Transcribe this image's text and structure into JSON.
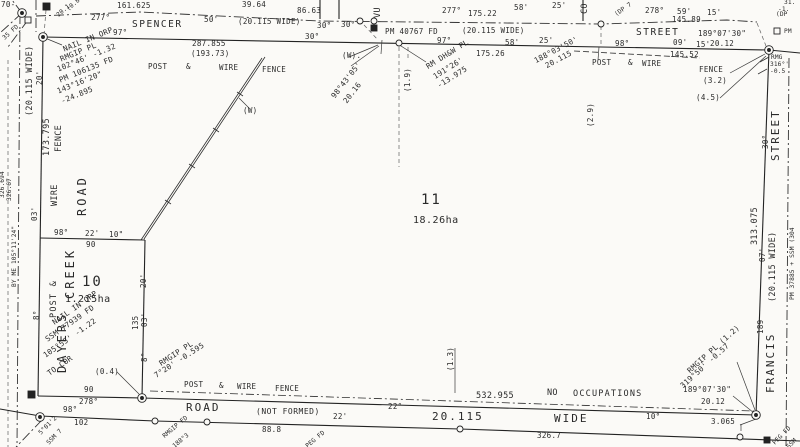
{
  "colors": {
    "paper": "#fbfaf7",
    "ink": "#2a2a2a"
  },
  "plan_summary": {
    "type": "cadastral survey plan (scanned)",
    "lots": [
      {
        "number": "10",
        "area": "1.215ha"
      },
      {
        "number": "11",
        "area": "18.26ha"
      }
    ],
    "streets": [
      "SPENCER STREET",
      "DAYERS CREEK ROAD",
      "FRANCIS STREET",
      "ROAD (NOT FORMED) 20.115 WIDE"
    ]
  },
  "labels": [
    {
      "n": "frag-70",
      "t": "70-",
      "x": 1,
      "y": 1
    },
    {
      "n": "frag-35fd",
      "t": "35 FD",
      "x": 2,
      "y": 37,
      "r": -42,
      "c": "t6"
    },
    {
      "n": "frag-20-1",
      "t": "20.1",
      "x": 56,
      "y": 14,
      "r": -42,
      "c": "t6"
    },
    {
      "n": "frag-0-8",
      "t": "(0.8",
      "x": 66,
      "y": 8,
      "r": -42,
      "c": "t6"
    },
    {
      "n": "dim-161-625",
      "t": "161.625",
      "x": 117,
      "y": 2
    },
    {
      "n": "dim-39-64",
      "t": "39.64",
      "x": 242,
      "y": 1
    },
    {
      "n": "brg-277-a",
      "t": "277°",
      "x": 91,
      "y": 14
    },
    {
      "n": "street-spencer",
      "t": "SPENCER",
      "x": 132,
      "y": 20,
      "c": "st"
    },
    {
      "n": "brg-97-a",
      "t": "97°",
      "x": 113,
      "y": 29
    },
    {
      "n": "dim-50",
      "t": "50'",
      "x": 204,
      "y": 16
    },
    {
      "n": "note-width-1",
      "t": "(20.115 WIDE)",
      "x": 238,
      "y": 18
    },
    {
      "n": "dim-86-63",
      "t": "86.63",
      "x": 297,
      "y": 7
    },
    {
      "n": "brg-30-a",
      "t": "30°",
      "x": 317,
      "y": 22
    },
    {
      "n": "brg-30-b",
      "t": "30°",
      "x": 341,
      "y": 21
    },
    {
      "n": "brg-30-c",
      "t": "30°",
      "x": 305,
      "y": 33
    },
    {
      "n": "street-vu-frag",
      "t": "VU",
      "x": 374,
      "y": 18,
      "r": -90,
      "c": "t8"
    },
    {
      "n": "mark-pm40767",
      "t": "PM 40767 FD",
      "x": 385,
      "y": 28
    },
    {
      "n": "brg-277-b",
      "t": "277°",
      "x": 442,
      "y": 7
    },
    {
      "n": "dim-58-a",
      "t": "58'",
      "x": 514,
      "y": 4
    },
    {
      "n": "dim-25-a",
      "t": "25'",
      "x": 552,
      "y": 2
    },
    {
      "n": "dim-175-22",
      "t": "175.22",
      "x": 468,
      "y": 10
    },
    {
      "n": "note-width-2",
      "t": "(20.115 WIDE)",
      "x": 462,
      "y": 27
    },
    {
      "n": "brg-97-b",
      "t": "97°",
      "x": 437,
      "y": 37
    },
    {
      "n": "dim-58-b",
      "t": "58'",
      "x": 505,
      "y": 39
    },
    {
      "n": "dim-175-26",
      "t": "175.26",
      "x": 476,
      "y": 50
    },
    {
      "n": "dim-287-855",
      "t": "287.855",
      "x": 192,
      "y": 40
    },
    {
      "n": "dim-193-73",
      "t": "(193.73)",
      "x": 191,
      "y": 50
    },
    {
      "n": "fence-post-1",
      "t": "POST",
      "x": 148,
      "y": 63
    },
    {
      "n": "fence-amp-1",
      "t": "&",
      "x": 186,
      "y": 63
    },
    {
      "n": "fence-wire-1",
      "t": "WIRE",
      "x": 219,
      "y": 64
    },
    {
      "n": "fence-fence-1",
      "t": "FENCE",
      "x": 262,
      "y": 66
    },
    {
      "n": "street-co-frag",
      "t": "CO",
      "x": 581,
      "y": 14,
      "r": -90,
      "c": "t8"
    },
    {
      "n": "frag-dp7",
      "t": "(DP 7",
      "x": 614,
      "y": 13,
      "r": -35,
      "c": "t6"
    },
    {
      "n": "brg-278",
      "t": "278°",
      "x": 645,
      "y": 7
    },
    {
      "n": "dim-59",
      "t": "59'",
      "x": 677,
      "y": 8
    },
    {
      "n": "dim-15-a",
      "t": "15'",
      "x": 707,
      "y": 9
    },
    {
      "n": "dim-145-89",
      "t": "145.89",
      "x": 672,
      "y": 16
    },
    {
      "n": "street-street-top",
      "t": "STREET",
      "x": 636,
      "y": 28,
      "c": "st"
    },
    {
      "n": "dim-25-b",
      "t": "25'",
      "x": 539,
      "y": 37
    },
    {
      "n": "brg-98-a",
      "t": "98°",
      "x": 615,
      "y": 40
    },
    {
      "n": "brg-189-07-30-a",
      "t": "189°07'30\"",
      "x": 698,
      "y": 30
    },
    {
      "n": "dim-20-12-a",
      "t": "20.12",
      "x": 710,
      "y": 40
    },
    {
      "n": "dim-09",
      "t": "09'",
      "x": 673,
      "y": 39
    },
    {
      "n": "dim-15-b",
      "t": "15'",
      "x": 696,
      "y": 41
    },
    {
      "n": "dim-145-52",
      "t": "145.52",
      "x": 670,
      "y": 51
    },
    {
      "n": "frag-31",
      "t": "31.",
      "x": 784,
      "y": 0,
      "c": "t6"
    },
    {
      "n": "frag-minus1",
      "t": "-1.",
      "x": 778,
      "y": 7,
      "c": "t6"
    },
    {
      "n": "frag-dp",
      "t": "(DP",
      "x": 776,
      "y": 12,
      "c": "t6"
    },
    {
      "n": "mark-pm-ne",
      "t": "PM",
      "x": 784,
      "y": 29,
      "c": "t6"
    },
    {
      "n": "frag-rmg",
      "t": "RMG",
      "x": 771,
      "y": 55,
      "c": "t6"
    },
    {
      "n": "frag-316",
      "t": "316°'",
      "x": 770,
      "y": 62,
      "c": "t6"
    },
    {
      "n": "frag-0-5",
      "t": "-0.5",
      "x": 770,
      "y": 69,
      "c": "t6"
    },
    {
      "n": "offset-188-03-50",
      "t": "188°03'50'",
      "x": 533,
      "y": 58,
      "r": -28
    },
    {
      "n": "offset-20-115",
      "t": "20.115",
      "x": 544,
      "y": 63,
      "r": -28
    },
    {
      "n": "fence-post-2",
      "t": "POST",
      "x": 592,
      "y": 59
    },
    {
      "n": "fence-amp-2",
      "t": "&",
      "x": 628,
      "y": 59
    },
    {
      "n": "fence-wire-2",
      "t": "WIRE",
      "x": 642,
      "y": 60
    },
    {
      "n": "offset-2-9",
      "t": "(2.9)",
      "x": 587,
      "y": 127,
      "r": -90
    },
    {
      "n": "fence-fence-2",
      "t": "FENCE",
      "x": 699,
      "y": 66
    },
    {
      "n": "offset-3-2",
      "t": "(3.2)",
      "x": 703,
      "y": 77
    },
    {
      "n": "offset-4-5",
      "t": "(4.5)",
      "x": 696,
      "y": 94
    },
    {
      "n": "note-w-dot",
      "t": "(W).",
      "x": 342,
      "y": 52
    },
    {
      "n": "offset-98-43-05",
      "t": "98°43'05'",
      "x": 330,
      "y": 95,
      "r": -52
    },
    {
      "n": "offset-20-16",
      "t": "20.16",
      "x": 342,
      "y": 100,
      "r": -52
    },
    {
      "n": "offset-1-9",
      "t": "(1.9)",
      "x": 404,
      "y": 92,
      "r": -90
    },
    {
      "n": "rm-dhw-1",
      "t": "RM DH&W PL",
      "x": 425,
      "y": 64,
      "r": -32
    },
    {
      "n": "rm-dhw-2",
      "t": "191°26'",
      "x": 432,
      "y": 74,
      "r": -32
    },
    {
      "n": "rm-dhw-3",
      "t": "-13.975",
      "x": 436,
      "y": 83,
      "r": -32
    },
    {
      "n": "note-w",
      "t": "(W)",
      "x": 243,
      "y": 107
    },
    {
      "n": "lot11-number",
      "t": "11",
      "x": 421,
      "y": 193,
      "c": "lot"
    },
    {
      "n": "lot11-area",
      "t": "18.26ha",
      "x": 413,
      "y": 216,
      "c": "ha"
    },
    {
      "n": "width-left",
      "t": "(20.115 WIDE)",
      "x": 26,
      "y": 116,
      "r": -90,
      "c": "t8"
    },
    {
      "n": "dim-20-left",
      "t": "20'",
      "x": 36,
      "y": 85,
      "r": -90
    },
    {
      "n": "dim-173-795",
      "t": "173.795",
      "x": 43,
      "y": 156,
      "r": -90,
      "c": "t8"
    },
    {
      "n": "fence-left-fence",
      "t": "FENCE",
      "x": 55,
      "y": 152,
      "r": -90,
      "c": "t8"
    },
    {
      "n": "fence-left-wire",
      "t": "WIRE",
      "x": 51,
      "y": 206,
      "r": -90,
      "c": "t8"
    },
    {
      "n": "road-dayers-road",
      "t": "ROAD",
      "x": 76,
      "y": 216,
      "r": -90,
      "c": "vn"
    },
    {
      "n": "dim-03-left",
      "t": "03'",
      "x": 31,
      "y": 221,
      "r": -90
    },
    {
      "n": "road-dayers-creek",
      "t": "CREEK",
      "x": 64,
      "y": 299,
      "r": -90,
      "c": "vn"
    },
    {
      "n": "road-dayers-dayers",
      "t": "DAYERS",
      "x": 56,
      "y": 373,
      "r": -90,
      "c": "vn"
    },
    {
      "n": "frag-326-694",
      "t": "326.694",
      "x": 0,
      "y": 198,
      "r": -90,
      "c": "t6"
    },
    {
      "n": "frag-326-67",
      "t": "326.67",
      "x": 7,
      "y": 201,
      "r": -90,
      "c": "t6"
    },
    {
      "n": "frag-by-me",
      "t": "BY ME 105°11'24\"",
      "x": 12,
      "y": 287,
      "r": -90,
      "c": "t6"
    },
    {
      "n": "lot10-brg-98",
      "t": "98°",
      "x": 54,
      "y": 229
    },
    {
      "n": "lot10-dim-22",
      "t": "22'",
      "x": 85,
      "y": 230
    },
    {
      "n": "lot10-dim-10sec",
      "t": "10\"",
      "x": 109,
      "y": 231
    },
    {
      "n": "lot10-dim-90-top",
      "t": "90",
      "x": 86,
      "y": 241
    },
    {
      "n": "lot10-number",
      "t": "10",
      "x": 82,
      "y": 275,
      "c": "lot"
    },
    {
      "n": "lot10-area",
      "t": "1.215ha",
      "x": 65,
      "y": 295,
      "c": "ha"
    },
    {
      "n": "fence-post-left",
      "t": "POST &",
      "x": 50,
      "y": 318,
      "r": -90,
      "c": "t8 ls1"
    },
    {
      "n": "brg-8-left",
      "t": "8°",
      "x": 33,
      "y": 320,
      "r": -90
    },
    {
      "n": "lot10-dim-135",
      "t": "135",
      "x": 132,
      "y": 330,
      "r": -90
    },
    {
      "n": "lot10-dim-03",
      "t": "03'",
      "x": 141,
      "y": 327,
      "r": -90
    },
    {
      "n": "lot10-dim-20",
      "t": "20'",
      "x": 140,
      "y": 288,
      "r": -90
    },
    {
      "n": "nail-sw-1",
      "t": "NAIL IN ORP",
      "x": 51,
      "y": 320,
      "r": -35
    },
    {
      "n": "nail-sw-2",
      "t": "SSM 77939 FD",
      "x": 44,
      "y": 337,
      "r": -35
    },
    {
      "n": "nail-sw-3",
      "t": "105°55' -1.22",
      "x": 42,
      "y": 353,
      "r": -35
    },
    {
      "n": "nail-sw-4",
      "t": "TO COR",
      "x": 46,
      "y": 371,
      "r": -35
    },
    {
      "n": "offset-0-4",
      "t": "(0.4)",
      "x": 95,
      "y": 368
    },
    {
      "n": "lot10-dim-90-bot",
      "t": "90",
      "x": 84,
      "y": 386
    },
    {
      "n": "lot10-brg-278",
      "t": "278°",
      "x": 79,
      "y": 398
    },
    {
      "n": "nail-nw-1",
      "t": "NAIL IN ORP",
      "x": 62,
      "y": 46,
      "r": -22
    },
    {
      "n": "nail-nw-2",
      "t": "RMGIP PL",
      "x": 59,
      "y": 56,
      "r": -22
    },
    {
      "n": "nail-nw-3",
      "t": "102°46' -1.32",
      "x": 56,
      "y": 66,
      "r": -22
    },
    {
      "n": "nail-nw-4",
      "t": "PM 106135 FD",
      "x": 58,
      "y": 77,
      "r": -22
    },
    {
      "n": "nail-nw-5",
      "t": "143°16'20\"",
      "x": 56,
      "y": 88,
      "r": -22
    },
    {
      "n": "nail-nw-6",
      "t": "-24.895",
      "x": 60,
      "y": 98,
      "r": -22
    },
    {
      "n": "rmgip-s-1",
      "t": "RMGIP PL",
      "x": 158,
      "y": 361,
      "r": -33
    },
    {
      "n": "rmgip-s-2",
      "t": "7°20' -0.595",
      "x": 153,
      "y": 373,
      "r": -33
    },
    {
      "n": "brg-8-mid",
      "t": "8°",
      "x": 141,
      "y": 362,
      "r": -90
    },
    {
      "n": "fence-post-3",
      "t": "POST",
      "x": 184,
      "y": 381
    },
    {
      "n": "fence-amp-3",
      "t": "&",
      "x": 219,
      "y": 382
    },
    {
      "n": "fence-wire-3",
      "t": "WIRE",
      "x": 237,
      "y": 383
    },
    {
      "n": "fence-fence-3",
      "t": "FENCE",
      "x": 275,
      "y": 385
    },
    {
      "n": "dim-532-955",
      "t": "532.955",
      "x": 476,
      "y": 392,
      "c": "t8"
    },
    {
      "n": "note-no",
      "t": "NO",
      "x": 547,
      "y": 389,
      "c": "t8"
    },
    {
      "n": "note-occupations",
      "t": "OCCUPATIONS",
      "x": 573,
      "y": 390,
      "c": "t8 ls1"
    },
    {
      "n": "offset-1-3",
      "t": "(1.3)",
      "x": 447,
      "y": 371,
      "r": -90
    },
    {
      "n": "rmgip-se-1",
      "t": "RMGIP PL (1.2)",
      "x": 686,
      "y": 369,
      "r": -42
    },
    {
      "n": "rmgip-se-2",
      "t": "319°50' -0.57",
      "x": 679,
      "y": 384,
      "r": -42
    },
    {
      "n": "brg-189-07-30-b",
      "t": "189°07'30\"",
      "x": 683,
      "y": 386
    },
    {
      "n": "dim-20-12-b",
      "t": "20.12",
      "x": 701,
      "y": 398
    },
    {
      "n": "dim-10deg",
      "t": "10°",
      "x": 646,
      "y": 413
    },
    {
      "n": "dim-3-065",
      "t": "3.065",
      "x": 711,
      "y": 418
    },
    {
      "n": "street-francis",
      "t": "FRANCIS",
      "x": 765,
      "y": 393,
      "r": -90,
      "c": "vn2"
    },
    {
      "n": "brg-189-right",
      "t": "189",
      "x": 757,
      "y": 334,
      "r": -90
    },
    {
      "n": "street-street-right",
      "t": "STREET",
      "x": 770,
      "y": 161,
      "r": -90,
      "c": "vn2"
    },
    {
      "n": "brg-30-right",
      "t": "30°",
      "x": 762,
      "y": 149,
      "r": -90
    },
    {
      "n": "dim-313-075",
      "t": "313.075",
      "x": 751,
      "y": 245,
      "r": -90,
      "c": "t8"
    },
    {
      "n": "dim-07-right",
      "t": "07'",
      "x": 759,
      "y": 262,
      "r": -90
    },
    {
      "n": "width-right",
      "t": "(20.115 WIDE)",
      "x": 769,
      "y": 302,
      "r": -90,
      "c": "t8"
    },
    {
      "n": "marks-right-col",
      "t": "PM 37885 + SSM (304",
      "x": 790,
      "y": 300,
      "r": -90,
      "c": "t6"
    },
    {
      "n": "road-bottom-road",
      "t": "ROAD",
      "x": 186,
      "y": 402,
      "c": "rd"
    },
    {
      "n": "road-bottom-notformed",
      "t": "(NOT FORMED)",
      "x": 256,
      "y": 408,
      "c": "nf"
    },
    {
      "n": "dim-22-a",
      "t": "22'",
      "x": 333,
      "y": 413
    },
    {
      "n": "dim-22-b",
      "t": "22°",
      "x": 388,
      "y": 403
    },
    {
      "n": "road-bottom-width",
      "t": "20.115",
      "x": 432,
      "y": 411,
      "c": "rd"
    },
    {
      "n": "road-bottom-wide",
      "t": "WIDE",
      "x": 554,
      "y": 413,
      "c": "rd"
    },
    {
      "n": "dim-88-8",
      "t": "88.8",
      "x": 262,
      "y": 426
    },
    {
      "n": "dim-326-7",
      "t": "326.7",
      "x": 537,
      "y": 432
    },
    {
      "n": "brg-98-bl",
      "t": "98°",
      "x": 63,
      "y": 406
    },
    {
      "n": "dim-102",
      "t": "102",
      "x": 74,
      "y": 419
    },
    {
      "n": "frag-5-01",
      "t": "5°01'2",
      "x": 38,
      "y": 432,
      "r": -45,
      "c": "t6"
    },
    {
      "n": "frag-ssm7",
      "t": "SSM 7",
      "x": 46,
      "y": 442,
      "r": -45,
      "c": "t6"
    },
    {
      "n": "frag-rmgip-fd",
      "t": "RMGIP FD",
      "x": 162,
      "y": 435,
      "r": -40,
      "c": "t6"
    },
    {
      "n": "frag-188-3",
      "t": "188°3",
      "x": 172,
      "y": 445,
      "r": -40,
      "c": "t6"
    },
    {
      "n": "frag-peg-fd-b",
      "t": "PEG FD",
      "x": 305,
      "y": 445,
      "r": -40,
      "c": "t6"
    },
    {
      "n": "frag-peg-fd-se",
      "t": "PEG FD",
      "x": 772,
      "y": 442,
      "r": -45,
      "c": "t6"
    },
    {
      "n": "frag-ssm-se",
      "t": "SSM",
      "x": 786,
      "y": 446,
      "r": -45,
      "c": "t6"
    }
  ]
}
